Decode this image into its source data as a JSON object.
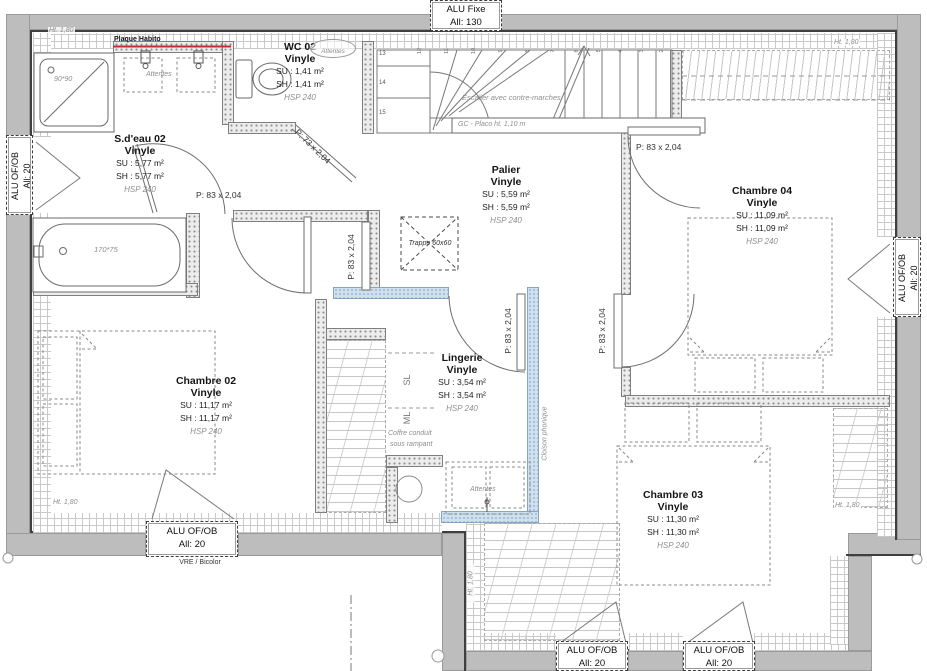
{
  "rooms": {
    "sdeau02": {
      "name": "S.d'eau 02",
      "floor": "Vinyle",
      "su": "SU : 5,77 m²",
      "sh": "SH : 5,77 m²",
      "hsp": "HSP 240"
    },
    "wc02": {
      "name": "WC 02",
      "floor": "Vinyle",
      "su": "SU : 1,41 m²",
      "sh": "SH : 1,41 m²",
      "hsp": "HSP 240"
    },
    "palier": {
      "name": "Palier",
      "floor": "Vinyle",
      "su": "SU : 5,59 m²",
      "sh": "SH : 5,59 m²",
      "hsp": "HSP 240"
    },
    "chambre04": {
      "name": "Chambre 04",
      "floor": "Vinyle",
      "su": "SU : 11,09 m²",
      "sh": "SH : 11,09 m²",
      "hsp": "HSP 240"
    },
    "chambre02": {
      "name": "Chambre 02",
      "floor": "Vinyle",
      "su": "SU : 11,17 m²",
      "sh": "SH : 11,17 m²",
      "hsp": "HSP 240"
    },
    "lingerie": {
      "name": "Lingerie",
      "floor": "Vinyle",
      "su": "SU : 3,54 m²",
      "sh": "SH : 3,54 m²",
      "hsp": "HSP 240"
    },
    "chambre03": {
      "name": "Chambre 03",
      "floor": "Vinyle",
      "su": "SU : 11,30 m²",
      "sh": "SH : 11,30 m²",
      "hsp": "HSP 240"
    }
  },
  "windows": {
    "top_fixe": {
      "line1": "ALU Fixe",
      "line2": "All: 130"
    },
    "left": {
      "line1": "ALU OF/OB",
      "line2": "All: 20"
    },
    "right": {
      "line1": "ALU OF/OB",
      "line2": "All: 20"
    },
    "bottom_left": {
      "line1": "ALU OF/OB",
      "line2": "All: 20",
      "subtitle": "VRE / Bicolor"
    },
    "bottom_center_1": {
      "line1": "ALU OF/OB",
      "line2": "All: 20"
    },
    "bottom_center_2": {
      "line1": "ALU OF/OB",
      "line2": "All: 20"
    }
  },
  "doors": {
    "p83": "P: 83 x 2,04",
    "p73": "P: 73 x 2,04"
  },
  "stairs": {
    "left_numbers": [
      "13",
      "14",
      "15"
    ],
    "top_numbers": [
      "12",
      "11",
      "10",
      "9",
      "8",
      "7",
      "6",
      "5",
      "4",
      "3",
      "2"
    ],
    "note": "Escalier avec contre-marches",
    "guard_note": "GC - Placo ht. 1,10 m"
  },
  "labels": {
    "ht180": "Ht. 1,80",
    "plaque_habito": "Plaque Habito",
    "attentes": "Attentes",
    "trappe": "Trappe 60x60",
    "sl": "SL",
    "ml": "ML",
    "coffre_line1": "Coffre conduit",
    "coffre_line2": "sous rampant",
    "cloison_phonique": "Cloison phonique",
    "tub_size": "170*75",
    "shower_size": "90*90"
  },
  "colors": {
    "accent_red": "#c03030",
    "wall_blue": "#cfe0ef"
  }
}
